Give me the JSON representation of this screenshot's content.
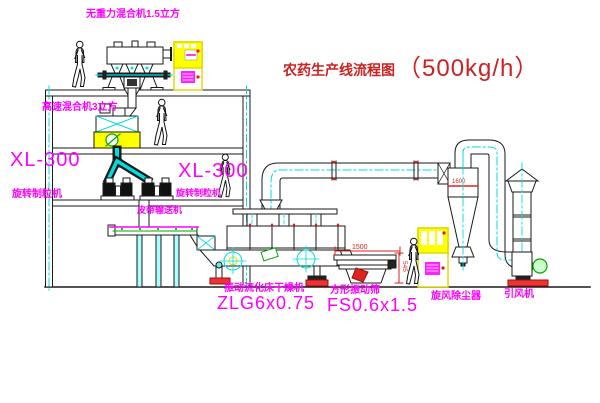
{
  "title": {
    "prefix": "农药生产线流程图",
    "capacity": "（500kg/h）"
  },
  "colors": {
    "label_magenta": "#ff00ff",
    "title_red": "#cc2222",
    "dimension_red": "#dd2222",
    "centerline_cyan": "#00dddd",
    "cabinet_yellow": "#ffff00"
  },
  "labels": {
    "gravity_mixer": "无重力混合机1.5立方",
    "high_speed_mixer": "高速混合机3立方",
    "granulator_left_model": "XL-300",
    "granulator_left_name": "旋转制粒机",
    "granulator_right_model": "XL-300",
    "granulator_right_name": "旋转制粒机",
    "belt_conveyor": "皮带输送机",
    "fluid_bed_dryer_name": "振动流化床干燥机",
    "fluid_bed_dryer_model": "ZLG6x0.75",
    "square_sieve_name": "方形振动筛",
    "square_sieve_model": "FS0.6x1.5",
    "cyclone": "旋风除尘器",
    "induced_draft_fan": "引风机"
  },
  "dimensions": {
    "sieve_length": "1500",
    "sieve_height": "545",
    "cyclone_mark": "1600"
  }
}
